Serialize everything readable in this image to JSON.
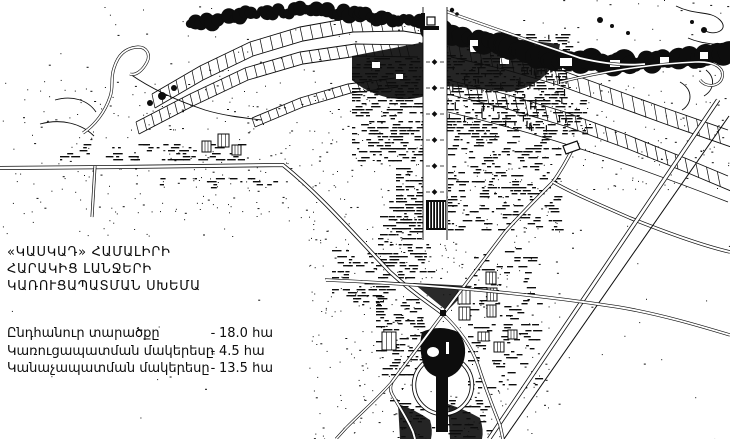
{
  "document": {
    "title_lines": [
      "«ԿԱՍԿԱԴ» ՀԱՄԱԼԻՐԻ",
      "ՀԱՐԱԿԻՑ ԼԱՆՋԵՐԻ",
      "ԿԱՌՈՒՑԱՊԱՏՄԱՆ ՍԽԵՄԱ"
    ],
    "legend": [
      {
        "label": "Ընդհանուր տարածքը",
        "separator": "-",
        "value": "18.0 հա"
      },
      {
        "label": "Կառուցապատման մակերեսը",
        "separator": "-",
        "value": "4.5 հա"
      },
      {
        "label": "Կանաչապատման մակերեսը",
        "separator": "-",
        "value": "13.5 հա"
      }
    ],
    "colors": {
      "ink": "#0d0d0d",
      "paper": "#ffffff"
    }
  }
}
